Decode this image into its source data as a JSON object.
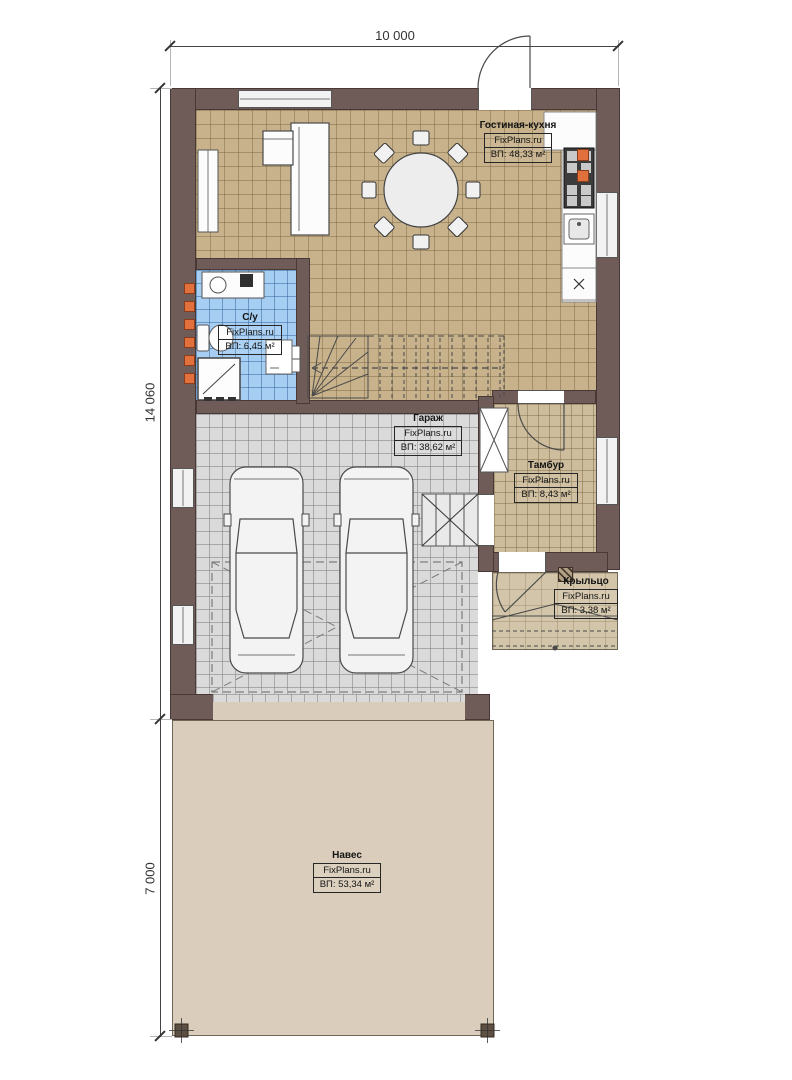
{
  "dimensions": {
    "width_total": "10 000",
    "height_house": "14 060",
    "height_canopy": "7 000"
  },
  "rooms": {
    "living_kitchen": {
      "name": "Гостиная-кухня",
      "brand": "FixPlans.ru",
      "area": "ВП: 48,33 м²"
    },
    "bathroom": {
      "name": "С/у",
      "brand": "FixPlans.ru",
      "area": "ВП: 6,45 м²"
    },
    "garage": {
      "name": "Гараж",
      "brand": "FixPlans.ru",
      "area": "ВП: 38,62 м²"
    },
    "tambour": {
      "name": "Тамбур",
      "brand": "FixPlans.ru",
      "area": "ВП: 8,43 м²"
    },
    "porch": {
      "name": "Крыльцо",
      "brand": "FixPlans.ru",
      "area": "ВП: 3,38 м²"
    },
    "canopy": {
      "name": "Навес",
      "brand": "FixPlans.ru",
      "area": "ВП: 53,34 м²"
    }
  },
  "colors": {
    "wall": "#6f5c59",
    "living_floor": "#c8b28c",
    "bathroom_floor": "#a6cef2",
    "garage_floor": "#dadada",
    "tambour_floor": "#cdbd9d",
    "canopy_floor": "#dacdbb",
    "marker": "#e2703d"
  }
}
